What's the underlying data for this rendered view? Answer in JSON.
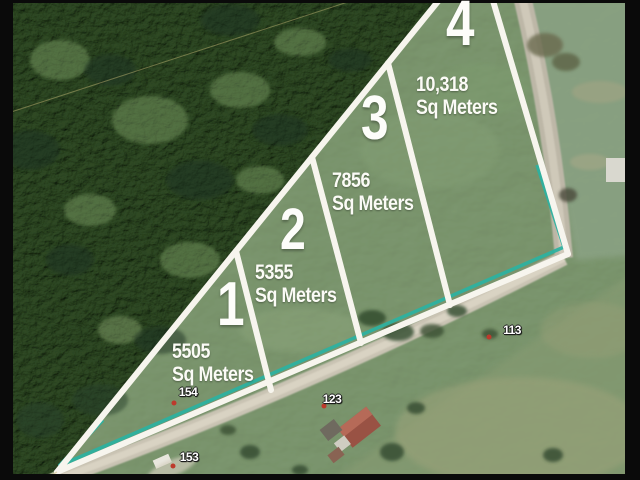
{
  "map": {
    "kind": "aerial-parcel-survey",
    "lots": [
      {
        "number": "1",
        "area": "5505",
        "unit": "Sq Meters"
      },
      {
        "number": "2",
        "area": "5355",
        "unit": "Sq Meters"
      },
      {
        "number": "3",
        "area": "7856",
        "unit": "Sq Meters"
      },
      {
        "number": "4",
        "area": "10,318",
        "unit": "Sq Meters"
      }
    ],
    "house_numbers": [
      "154",
      "153",
      "123",
      "113"
    ],
    "colors": {
      "boundary_line": "#f7f5ee",
      "survey_teal": "#28b3a2",
      "label_text": "#ffffff",
      "marker_red": "#c0392b"
    }
  }
}
